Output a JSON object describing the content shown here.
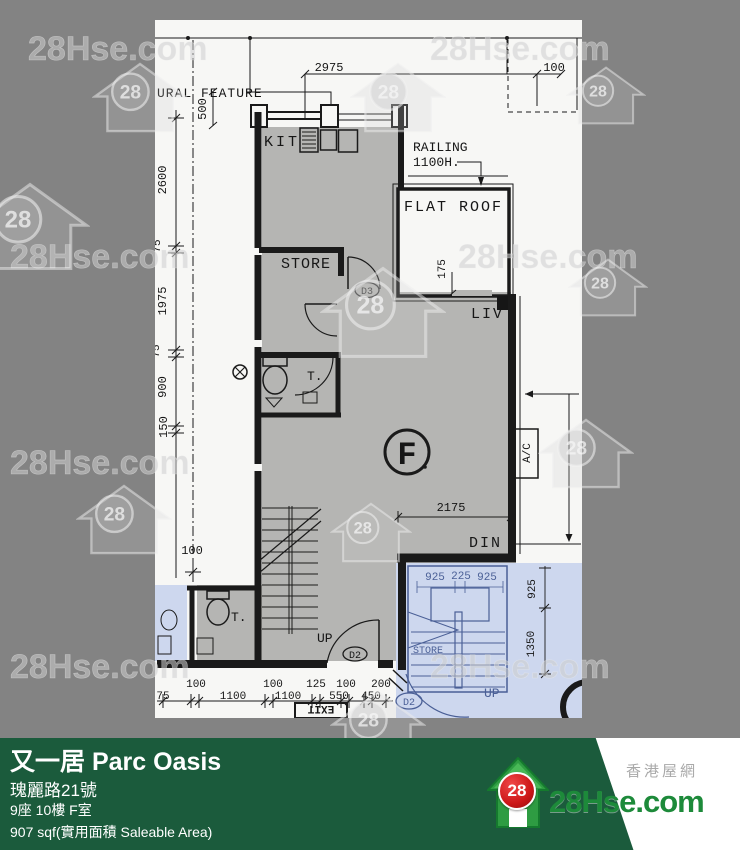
{
  "watermark": {
    "text": "28Hse.com",
    "badge": "28"
  },
  "plan": {
    "labels": {
      "feature": "URAL FEATURE",
      "kit": "KIT",
      "railing1": "RAILING",
      "railing2": "1100H.",
      "flat_roof": "FLAT ROOF",
      "store": "STORE",
      "liv": "LIV",
      "din": "DIN",
      "toilet_upper": "T.",
      "toilet_lower": "T.",
      "unit": "F",
      "ac": "A/C",
      "up_unit": "UP",
      "up_common": "UP",
      "door_d3": "D3",
      "door_d2_unit": "D2",
      "door_d2_common": "D2",
      "store_common": "STORE",
      "exit": "EXIT"
    },
    "dims": {
      "top_width": "2975",
      "top_offset": "100",
      "top_recess": "500",
      "left": [
        "2600",
        "75",
        "1975",
        "75",
        "900",
        "150",
        "100"
      ],
      "living_width": "2175",
      "flat_roof_inset": "175",
      "bottom_row1": [
        "100",
        "100",
        "125",
        "100",
        "200"
      ],
      "bottom_row2": [
        "75",
        "1100",
        "1100",
        "550",
        "450"
      ],
      "stair_row": [
        "925",
        "225",
        "925"
      ],
      "stair_col": [
        "925",
        "1350"
      ]
    }
  },
  "footer": {
    "title": "又一居 Parc Oasis",
    "address": "瑰麗路21號",
    "unit": "9座 10樓 F室",
    "area": "907 sqf(實用面積 Saleable Area)"
  },
  "logo": {
    "badge": "28",
    "site": "28Hse.com",
    "tagline": "香港屋網"
  },
  "colors": {
    "bar_green": "#1b5b3c",
    "logo_red": "#cc1718",
    "logo_green": "#1d8a3a",
    "blueprint_blue": "#4a5f96",
    "blue_fill": "#cdd7ee",
    "unit_gray": "#b5b5b3",
    "canvas_gray": "#838383",
    "paper": "#f7f7f5"
  }
}
